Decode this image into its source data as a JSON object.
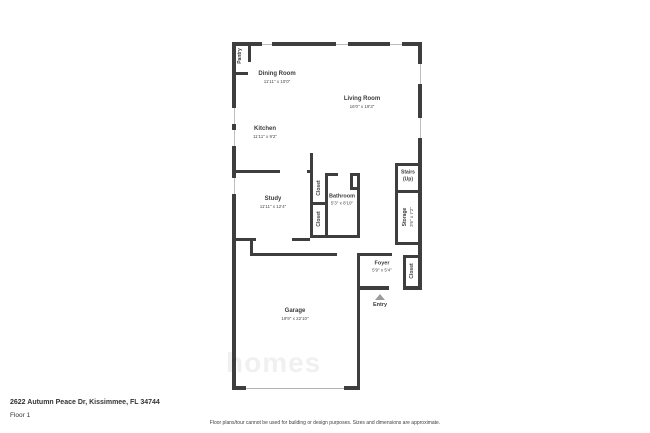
{
  "address": "2622 Autumn Peace Dr, Kissimmee, FL 34744",
  "floor": "Floor 1",
  "disclaimer": "Floor plans/tour cannot be used for building or design purposes. Sizes and dimensions are approximate.",
  "watermark": "homes",
  "entry": {
    "label": "Entry"
  },
  "colors": {
    "wall": "#3e3e3e",
    "window": "#bdbdbd",
    "entry_arrow": "#9b9b9b"
  },
  "rooms": {
    "pantry": {
      "name": "Pantry"
    },
    "dining_room": {
      "name": "Dining Room",
      "dims": "11'11\" x 10'0\""
    },
    "living_room": {
      "name": "Living Room",
      "dims": "16'0\" x 19'3\""
    },
    "kitchen": {
      "name": "Kitchen",
      "dims": "11'11\" x 9'2\""
    },
    "study": {
      "name": "Study",
      "dims": "11'11\" x 12'4\""
    },
    "closet_hall_upper": {
      "name": "Closet"
    },
    "closet_hall_lower": {
      "name": "Closet"
    },
    "bathroom": {
      "name": "Bathroom",
      "dims": "5'3\" x 8'10\""
    },
    "stairs": {
      "name": "Stairs",
      "sub": "(Up)"
    },
    "storage": {
      "name": "Storage",
      "dims": "3'6\" x 7'2\""
    },
    "foyer": {
      "name": "Foyer",
      "dims": "5'9\" x 5'4\""
    },
    "closet_foyer": {
      "name": "Closet"
    },
    "garage": {
      "name": "Garage",
      "dims": "19'9\" x 22'10\""
    }
  }
}
